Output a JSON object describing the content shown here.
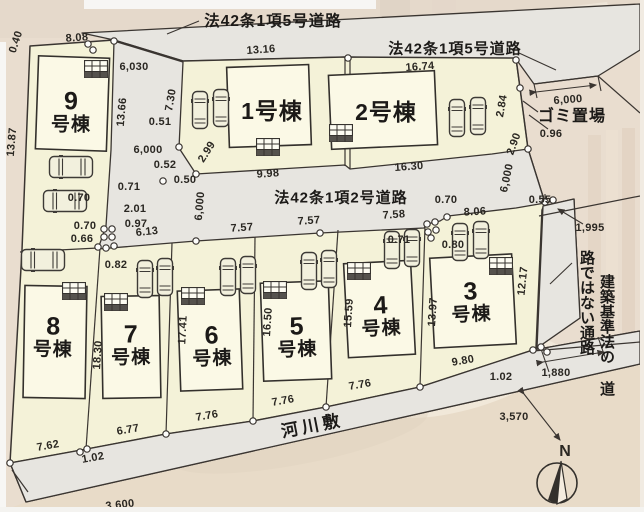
{
  "plan": {
    "road_labels": {
      "top": "法42条1項5号道路",
      "right": "法42条1項5号道路",
      "middle": "法42条1項2号道路",
      "riverbed": "河川敷",
      "garbage": "ゴミ置場",
      "passage_col_right": "建築基準法の",
      "passage_col_left": "道路ではない通路"
    },
    "buildings": {
      "b1": {
        "label": "1号棟"
      },
      "b2": {
        "label": "2号棟"
      },
      "b3": {
        "num": "3",
        "suffix": "号棟"
      },
      "b4": {
        "num": "4",
        "suffix": "号棟"
      },
      "b5": {
        "num": "5",
        "suffix": "号棟"
      },
      "b6": {
        "num": "6",
        "suffix": "号棟"
      },
      "b7": {
        "num": "7",
        "suffix": "号棟"
      },
      "b8": {
        "num": "8",
        "suffix": "号棟"
      },
      "b9": {
        "num": "9",
        "suffix": "号棟"
      }
    },
    "dims": {
      "d0_40": "0.40",
      "d8_08": "8.08",
      "d6030": "6,030",
      "d13_16": "13.16",
      "d16_74": "16.74",
      "d13_87": "13.87",
      "d13_66": "13.66",
      "d7_30": "7.30",
      "d0_51": "0.51",
      "d6000_a": "6,000",
      "d0_52": "0.52",
      "d0_50": "0.50",
      "d2_99": "2.99",
      "d9_98": "9.98",
      "d16_30": "16.30",
      "d2_84": "2.84",
      "d6000_g": "6,000",
      "d0_96": "0.96",
      "d2_90": "2.90",
      "d6000_p": "6,000",
      "d0_55": "0.55",
      "d1995": "1,995",
      "d0_70a": "0.70",
      "d8_06": "8.06",
      "d7_58": "7.58",
      "d7_57a": "7.57",
      "d7_57b": "7.57",
      "d0_71a": "0.71",
      "d0_70b": "0.70",
      "d2_01": "2.01",
      "d0_97": "0.97",
      "d0_70c": "0.70",
      "d0_66": "0.66",
      "d6_13": "6.13",
      "d6000_m": "6,000",
      "d0_82": "0.82",
      "d0_71b": "0.71",
      "d0_80": "0.80",
      "d18_30": "18.30",
      "d17_41": "17.41",
      "d16_50": "16.50",
      "d15_59": "15.59",
      "d13_97": "13.97",
      "d12_17": "12.17",
      "d7_62": "7.62",
      "d1_02a": "1.02",
      "d6_77": "6.77",
      "d7_76a": "7.76",
      "d7_76b": "7.76",
      "d7_76c": "7.76",
      "d9_80": "9.80",
      "d1_02b": "1.02",
      "d1880": "1,880",
      "d3570": "3,570",
      "d3600": "3,600"
    },
    "compass_n": "N"
  }
}
